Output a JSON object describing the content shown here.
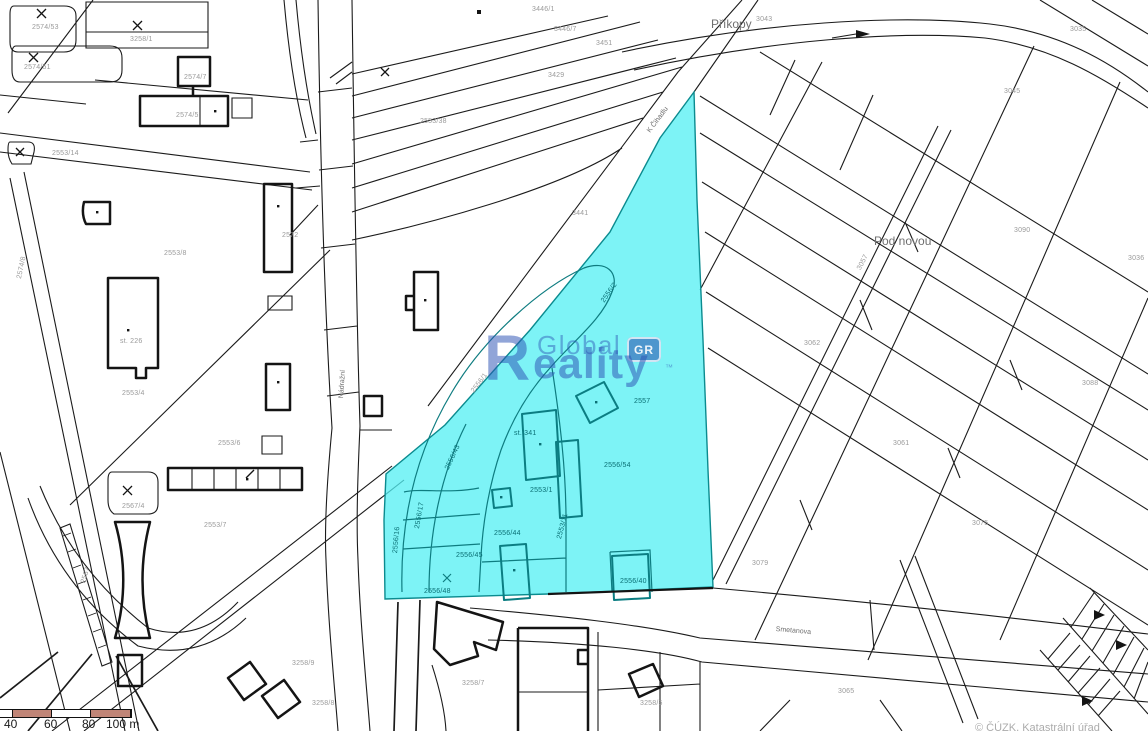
{
  "map": {
    "background": "#ffffff",
    "line_color": "#1b1b1b",
    "highlight": {
      "fill": "rgba(82,239,243,0.75)",
      "stroke": "#0b8b8f",
      "label": "highlighted parcel"
    },
    "watermark": {
      "logo_r": "R",
      "word1": "Global",
      "word2_rest": "eality",
      "badge": "GR",
      "tm": "™",
      "color": "#2d52b4"
    },
    "street_labels": [
      {
        "t": "Příkopy",
        "x": 711,
        "y": 17,
        "s": 12
      },
      {
        "t": "Pod novou",
        "x": 874,
        "y": 234,
        "s": 12
      },
      {
        "t": "K Čihadlu",
        "x": 646,
        "y": 130,
        "s": 7,
        "r": -53
      },
      {
        "t": "Smetanova",
        "x": 776,
        "y": 626,
        "s": 7,
        "r": 5
      },
      {
        "t": "Nádražní",
        "x": 338,
        "y": 398,
        "s": 7,
        "r": -86
      }
    ],
    "parcel_labels": [
      {
        "t": "2574/53",
        "x": 32,
        "y": 24
      },
      {
        "t": "2574/51",
        "x": 24,
        "y": 64
      },
      {
        "t": "3258/1",
        "x": 130,
        "y": 36
      },
      {
        "t": "2574/7",
        "x": 184,
        "y": 74
      },
      {
        "t": "2574/5",
        "x": 176,
        "y": 112
      },
      {
        "t": "2553/14",
        "x": 52,
        "y": 150
      },
      {
        "t": "2574/8",
        "x": 16,
        "y": 278,
        "r": -78
      },
      {
        "t": "2553/8",
        "x": 164,
        "y": 250
      },
      {
        "t": "2553/4",
        "x": 122,
        "y": 390
      },
      {
        "t": "2553/6",
        "x": 218,
        "y": 440
      },
      {
        "t": "2567/4",
        "x": 122,
        "y": 503
      },
      {
        "t": "2553/7",
        "x": 204,
        "y": 522
      },
      {
        "t": "2567",
        "x": 80,
        "y": 582,
        "r": -72
      },
      {
        "t": "2553/38",
        "x": 420,
        "y": 118
      },
      {
        "t": "3441",
        "x": 572,
        "y": 210
      },
      {
        "t": "3446/1",
        "x": 532,
        "y": 6
      },
      {
        "t": "3446/7",
        "x": 554,
        "y": 26
      },
      {
        "t": "3451",
        "x": 596,
        "y": 40
      },
      {
        "t": "3429",
        "x": 548,
        "y": 72
      },
      {
        "t": "2556/1",
        "x": 470,
        "y": 390,
        "r": -53
      },
      {
        "t": "2572",
        "x": 282,
        "y": 232
      },
      {
        "t": "st. 226",
        "x": 120,
        "y": 338
      },
      {
        "t": "3043",
        "x": 756,
        "y": 16
      },
      {
        "t": "3035",
        "x": 1070,
        "y": 26
      },
      {
        "t": "3045",
        "x": 1004,
        "y": 88
      },
      {
        "t": "3090",
        "x": 1014,
        "y": 227
      },
      {
        "t": "3062",
        "x": 804,
        "y": 340
      },
      {
        "t": "3057",
        "x": 856,
        "y": 268,
        "r": -62
      },
      {
        "t": "3088",
        "x": 1082,
        "y": 380
      },
      {
        "t": "3061",
        "x": 893,
        "y": 440
      },
      {
        "t": "3075",
        "x": 972,
        "y": 520
      },
      {
        "t": "3079",
        "x": 752,
        "y": 560
      },
      {
        "t": "3036",
        "x": 1128,
        "y": 255
      },
      {
        "t": "3065",
        "x": 838,
        "y": 688
      },
      {
        "t": "3258/9",
        "x": 292,
        "y": 660
      },
      {
        "t": "3258/7",
        "x": 462,
        "y": 680
      },
      {
        "t": "3258/5",
        "x": 640,
        "y": 700
      },
      {
        "t": "3258/8",
        "x": 312,
        "y": 700
      }
    ],
    "parcel_labels_highlight": [
      {
        "t": "2556/2",
        "x": 600,
        "y": 300,
        "r": -55
      },
      {
        "t": "2557",
        "x": 634,
        "y": 398
      },
      {
        "t": "st. 341",
        "x": 514,
        "y": 430
      },
      {
        "t": "2556/54",
        "x": 604,
        "y": 462
      },
      {
        "t": "2553/1",
        "x": 530,
        "y": 487
      },
      {
        "t": "2556/43",
        "x": 444,
        "y": 468,
        "r": -65
      },
      {
        "t": "2556/17",
        "x": 414,
        "y": 528,
        "r": -80
      },
      {
        "t": "2556/45",
        "x": 456,
        "y": 552
      },
      {
        "t": "2556/44",
        "x": 494,
        "y": 530
      },
      {
        "t": "2553/11",
        "x": 556,
        "y": 538,
        "r": -75
      },
      {
        "t": "2556/48",
        "x": 424,
        "y": 588
      },
      {
        "t": "2556/40",
        "x": 620,
        "y": 578
      },
      {
        "t": "2556/16",
        "x": 392,
        "y": 553,
        "r": -85
      }
    ],
    "scale_bar": {
      "segment_color": "#c08577",
      "segments": [
        {
          "w": 12,
          "c": "#ffffff"
        },
        {
          "w": 38,
          "c": "#c08577"
        },
        {
          "w": 38,
          "c": "#ffffff"
        },
        {
          "w": 39,
          "c": "#c08577"
        }
      ],
      "tick_labels": [
        {
          "t": "40",
          "x": 4
        },
        {
          "t": "60",
          "x": 44
        },
        {
          "t": "80",
          "x": 82
        },
        {
          "t": "100 m",
          "x": 106
        }
      ]
    },
    "attribution": "© ČÚZK, Katastrální úřad"
  }
}
